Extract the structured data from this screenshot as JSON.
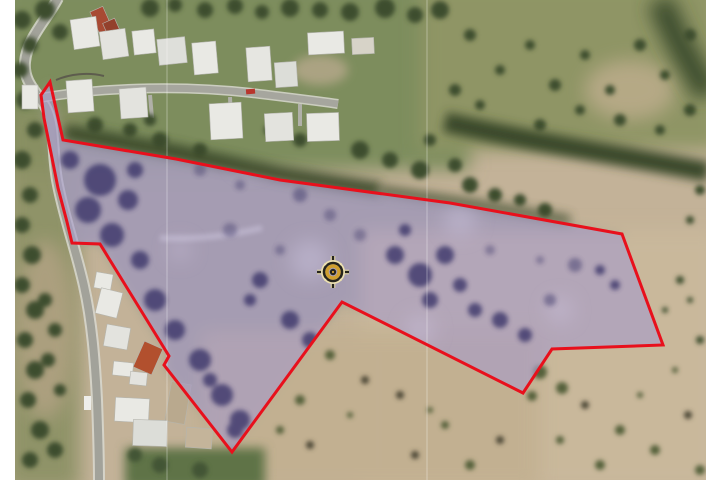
{
  "map": {
    "description": "aerial-satellite-view-of-land-parcel",
    "canvas": {
      "width": 720,
      "height": 480
    },
    "frame_color": "#ffffff",
    "boundary": {
      "color": "#e8101c",
      "width": 3,
      "points": "50,82 63,140 176,159 280,180 450,203 622,234 663,345 552,349 523,393 342,302 232,452 164,365 169,356 100,244 72,243 67,222 58,188 52,158 44,118 41,95"
    },
    "parcel_fill": {
      "color": "#a79bc9",
      "opacity": 0.62
    },
    "marker": {
      "name": "center-target",
      "transform": "translate(333,272)",
      "outer_ring_color": "#ece0b0",
      "dark_color": "#26251d",
      "gold_color": "#d09f2e"
    },
    "terrain_colors": {
      "field_tan": "#c3b298",
      "grass_green": "#7d8d5d",
      "olive_field": "#8f9565",
      "tree_dark": "#3d4d2e",
      "road_gray": "#a2a29a",
      "roof_white": "#e9e9e4",
      "roof_red": "#a84a33",
      "tree_in_parcel": "#3b3569"
    },
    "seam_lines_x": [
      167,
      427
    ]
  }
}
